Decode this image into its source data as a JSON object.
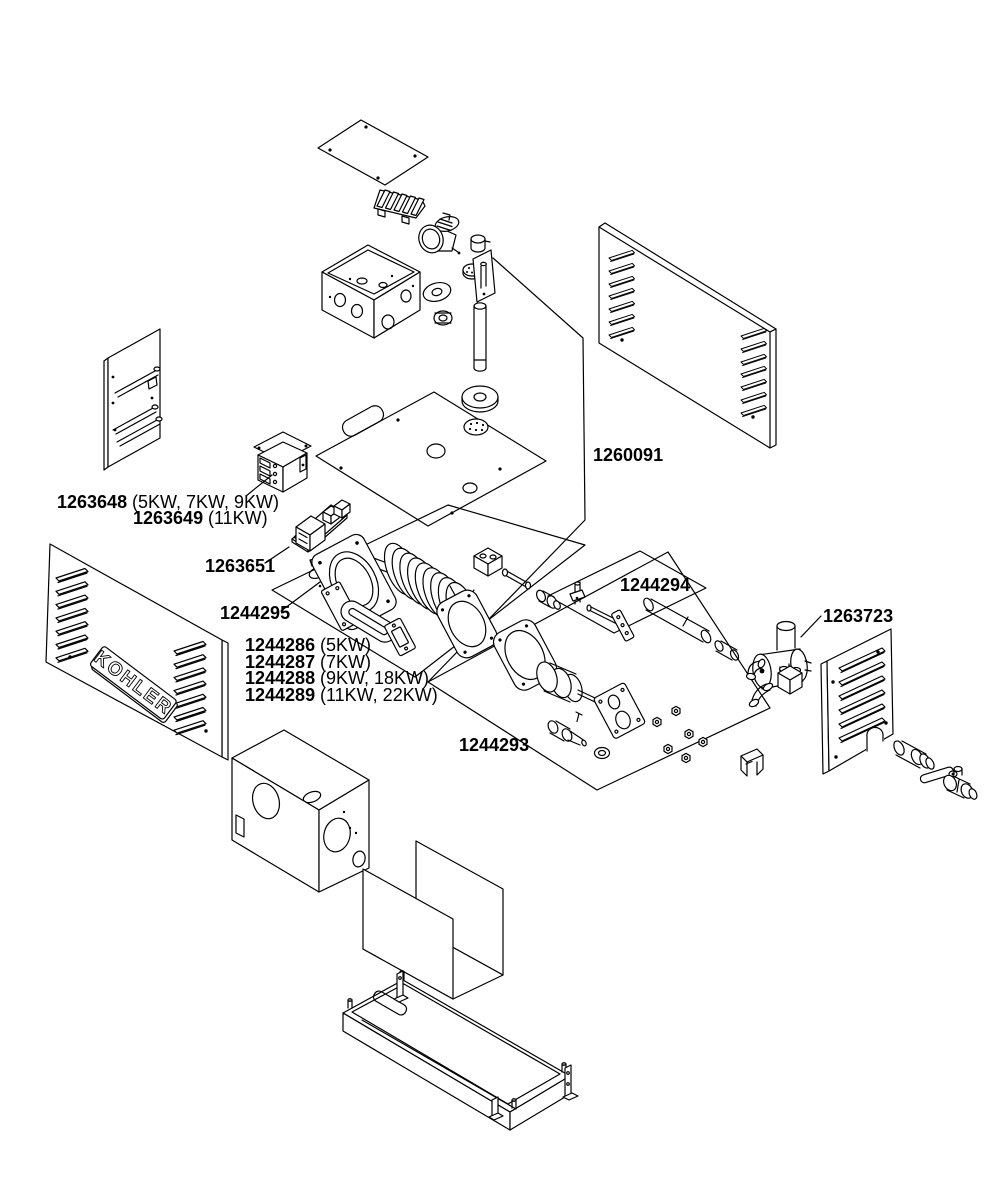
{
  "diagram": {
    "brand_logo": "KOHLER",
    "colors": {
      "line": "#000000",
      "background": "#ffffff"
    },
    "labels": {
      "p1263648": {
        "part": "1263648",
        "variants": "(5KW, 7KW, 9KW)"
      },
      "p1263649": {
        "part": "1263649",
        "variants": "(11KW)"
      },
      "p1263651": {
        "part": "1263651",
        "variants": ""
      },
      "p1244295": {
        "part": "1244295",
        "variants": ""
      },
      "p1244286": {
        "part": "1244286",
        "variants": "(5KW)"
      },
      "p1244287": {
        "part": "1244287",
        "variants": "(7KW)"
      },
      "p1244288": {
        "part": "1244288",
        "variants": "(9KW, 18KW)"
      },
      "p1244289": {
        "part": "1244289",
        "variants": "(11KW, 22KW)"
      },
      "p1260091": {
        "part": "1260091",
        "variants": ""
      },
      "p1244294": {
        "part": "1244294",
        "variants": ""
      },
      "p1263723": {
        "part": "1263723",
        "variants": ""
      },
      "p1244293": {
        "part": "1244293",
        "variants": ""
      }
    }
  }
}
